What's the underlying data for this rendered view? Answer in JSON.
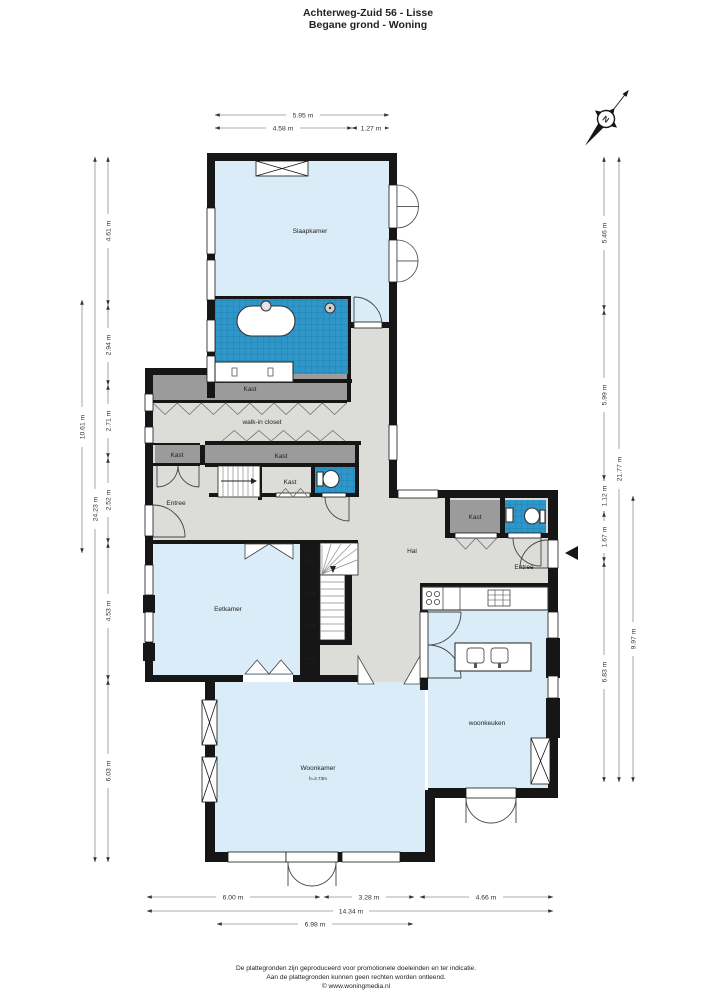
{
  "header": {
    "title": "Achterweg-Zuid 56 - Lisse",
    "subtitle": "Begane grond - Woning"
  },
  "compass": {
    "north_label": "N"
  },
  "labels": {
    "slaapkamer": "Slaapkamer",
    "kast": "Kast",
    "walk_in_closet": "walk-in closet",
    "entree": "Entree",
    "hal": "Hal",
    "eetkamer": "Eetkamer",
    "woonkamer": "Woonkamer",
    "woonkamer_height": "h=2.73m",
    "woonkeuken": "woonkeuken"
  },
  "dimensions": {
    "top": [
      "5.95 m",
      "4.58 m",
      "1.27 m"
    ],
    "left": [
      "10.61 m",
      "24.23 m",
      "4.61 m",
      "2.94 m",
      "2.71 m",
      "2.52 m",
      "4.53 m",
      "6.03 m"
    ],
    "right": [
      "5.46 m",
      "5.99 m",
      "1.12 m",
      "1.67 m",
      "6.83 m",
      "21.77 m",
      "9.97 m"
    ],
    "bottom": [
      "6.00 m",
      "3.28 m",
      "4.66 m",
      "14.34 m",
      "6.98 m"
    ]
  },
  "footer": {
    "line1": "De plattegronden zijn geproduceerd voor promotionele doeleinden en ter indicatie.",
    "line2": "Aan de plattegronden kunnen geen rechten worden ontleend.",
    "line3": "© www.woningmedia.nl"
  },
  "colors": {
    "wall": "#161616",
    "floor_gray": "#dcdcd9",
    "room_blue": "#d9ecf7",
    "closet_gray": "#9b9b9c",
    "tile_blue": "#2e96c9"
  }
}
